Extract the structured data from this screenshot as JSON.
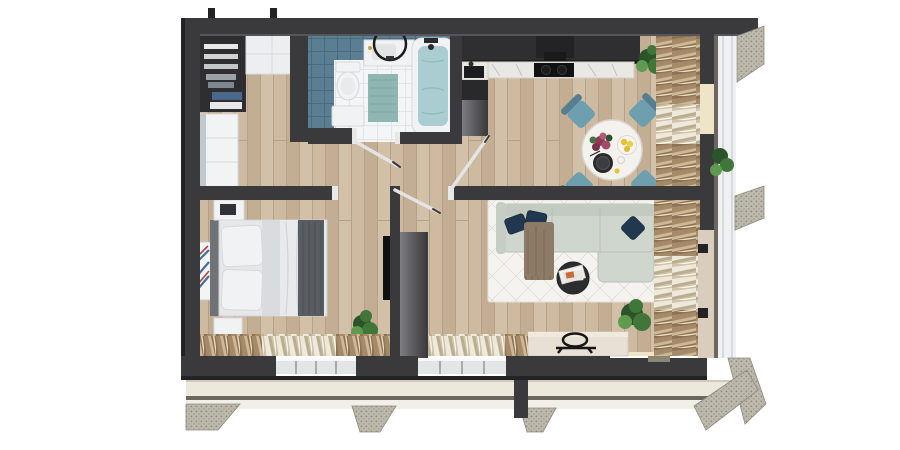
{
  "scene": {
    "description": "3D top-down rendering of a one-bedroom apartment floor plan with balcony",
    "view": "top-down render, no text labels",
    "background": "#ffffff"
  },
  "palette": {
    "bg": "#ffffff",
    "wall": "#3a3a3c",
    "wallDark": "#232325",
    "woodA": "#cdbaa1",
    "woodB": "#c3ae94",
    "woodC": "#d2c0a8",
    "woodLine": "#b5a088",
    "tileBlue": "#5a7f92",
    "tileBlueLine": "#4a6b7d",
    "tileWhite": "#f4f5f6",
    "tileWhiteLine": "#e1e5e8",
    "marble": "#eae8e4",
    "sofa": "#cfd6cd",
    "pillowNavy": "#21384f",
    "chairTeal": "#6d9fae",
    "chairTealDark": "#557f90",
    "throwBrown": "#8d7b68",
    "rug": "#f5f3f0",
    "rugLine": "#dcd8d2",
    "curtainBrown": "#8d7356",
    "curtainCream": "#cfc3a8",
    "plant": "#41763a",
    "plantDark": "#2c5429",
    "plantLight": "#5f9a50",
    "water": "#a9cdd0",
    "balconyFloor": "#ece8dc",
    "railing": "#6b675e",
    "hatch": "#bdb9ad",
    "hatchDot": "#8e8a7e",
    "litCream": "#f0e4c9"
  },
  "rooms": {
    "bathroom": {
      "objects": [
        "toilet",
        "washbasin-cabinet",
        "round-mirror",
        "bathtub",
        "teal-bath-mat",
        "storage-bench",
        "blue-wall-tiles",
        "open-door"
      ]
    },
    "entry": {
      "objects": [
        "open-wardrobe-shelves",
        "white-upper-cabinets",
        "white-dresser"
      ]
    },
    "kitchen": {
      "objects": [
        "dark-tall-cabinets",
        "range-hood",
        "marble-countertop",
        "black-cooktop",
        "sink-counter",
        "potted-plant",
        "window-curtains"
      ]
    },
    "dining": {
      "objects": [
        "round-marble-table",
        "teal-chair-x4",
        "flower-bouquet",
        "lemon-bowl",
        "dark-plate",
        "cup"
      ]
    },
    "bedroom": {
      "objects": [
        "double-bed",
        "headboard",
        "pillows",
        "gray-duvet",
        "dark-foot-throw",
        "nightstand-x2",
        "wall-art",
        "wall-tv",
        "potted-plant",
        "window-curtains",
        "open-door"
      ]
    },
    "living": {
      "objects": [
        "l-shaped-sofa",
        "navy-pillow-x3",
        "brown-throw",
        "geometric-rug",
        "round-coffee-table",
        "magazines",
        "tv-console",
        "decor-tray",
        "potted-plant",
        "window-curtains",
        "partition-cabinet"
      ]
    },
    "balcony": {
      "objects": [
        "floor-slab",
        "railing",
        "concrete-support-x3",
        "corner-slab-section",
        "potted-plant",
        "glass-facade"
      ]
    }
  }
}
